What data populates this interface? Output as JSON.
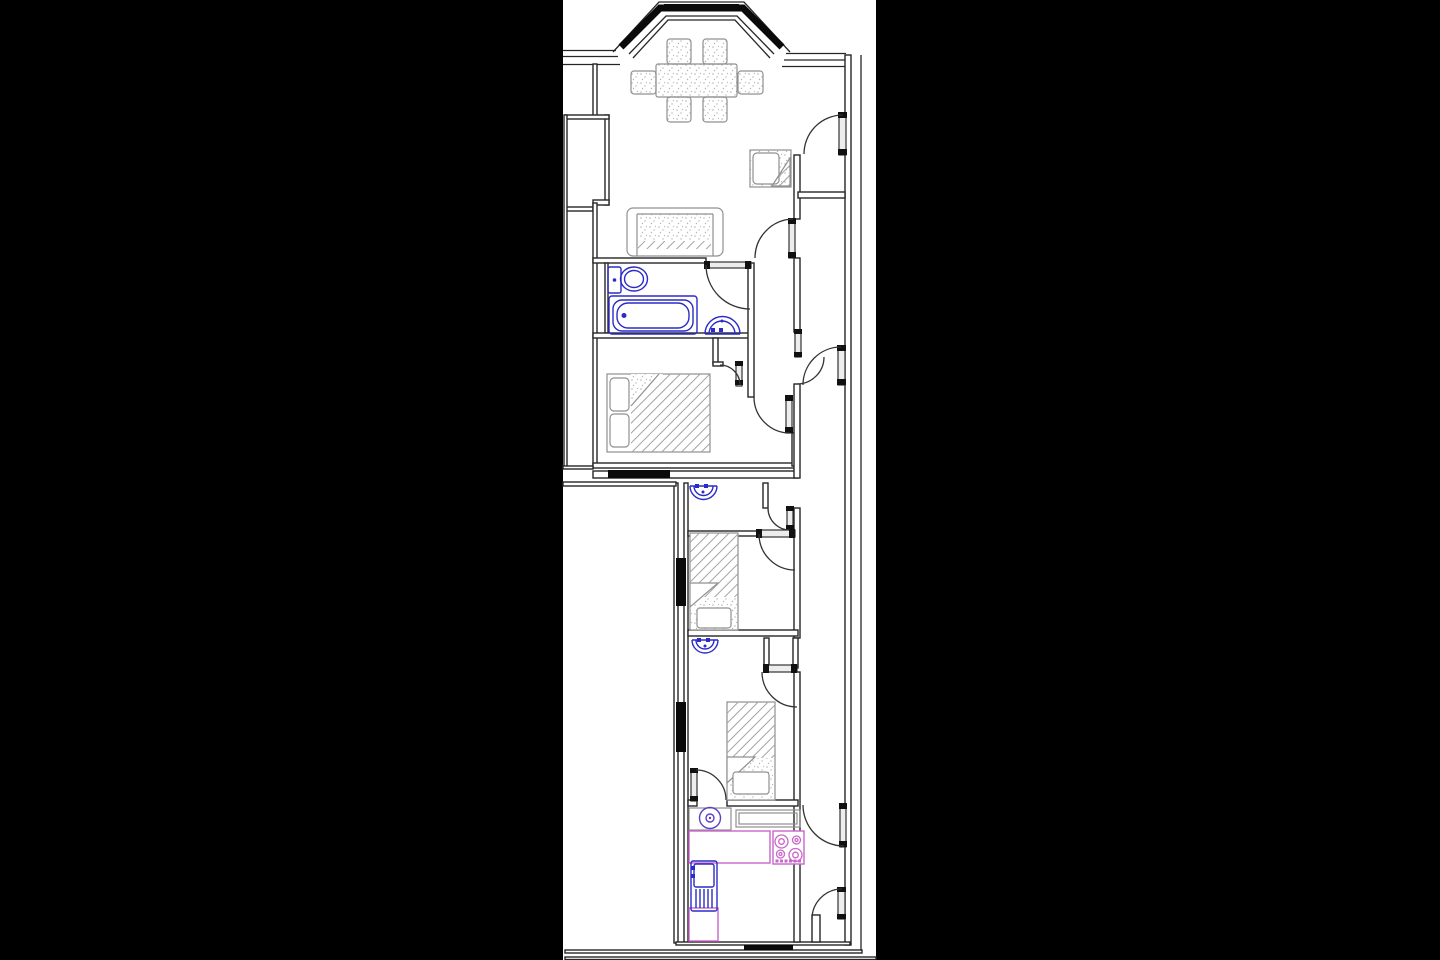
{
  "page": {
    "background": "#000000",
    "paper": "#ffffff"
  },
  "colors": {
    "page_bg": "#000000",
    "paper": "#ffffff",
    "wall_ink": "#262626",
    "glazing_black": "#0a0a0a",
    "furniture_gray": "#909090",
    "fixture_blue": "#2b2bc7",
    "kitchen_magenta": "#c966c9",
    "appliance_violet": "#5b3fc9"
  },
  "plan": {
    "type": "residential-floor-plan",
    "drawing_style": "CAD line drawing, no text labels",
    "rooms": [
      {
        "name": "living-dining-room",
        "position": "top",
        "fixtures": [
          "bay-window",
          "dining-table",
          "six-chairs",
          "sofa",
          "armchair"
        ]
      },
      {
        "name": "bathroom",
        "position": "upper-left",
        "fixtures": [
          "toilet",
          "bathtub",
          "wash-basin"
        ]
      },
      {
        "name": "bedroom-1",
        "position": "upper",
        "fixtures": [
          "double-bed",
          "window"
        ]
      },
      {
        "name": "wc-room",
        "position": "middle",
        "fixtures": [
          "wash-basin"
        ]
      },
      {
        "name": "bedroom-2",
        "position": "middle",
        "fixtures": [
          "single-bed",
          "window"
        ]
      },
      {
        "name": "bedroom-3",
        "position": "lower",
        "fixtures": [
          "single-bed",
          "wash-basin",
          "window"
        ]
      },
      {
        "name": "kitchen",
        "position": "bottom",
        "fixtures": [
          "worktop-counter",
          "hob-4-burners",
          "sink-with-drainer",
          "washing-machine",
          "window"
        ]
      },
      {
        "name": "corridor",
        "position": "right",
        "fixtures": [
          "threshold-line",
          "doors"
        ]
      }
    ],
    "door_count": 13,
    "window_glazing_segments": 7,
    "fixture_color_legend": {
      "blue": "sanitary fixtures (toilet, bath, basins, kitchen sink)",
      "magenta": "kitchen counters and hob",
      "violet": "washing machine drum",
      "black": "window glazing in walls",
      "gray": "furniture (beds, sofa, chairs, tables)"
    }
  }
}
